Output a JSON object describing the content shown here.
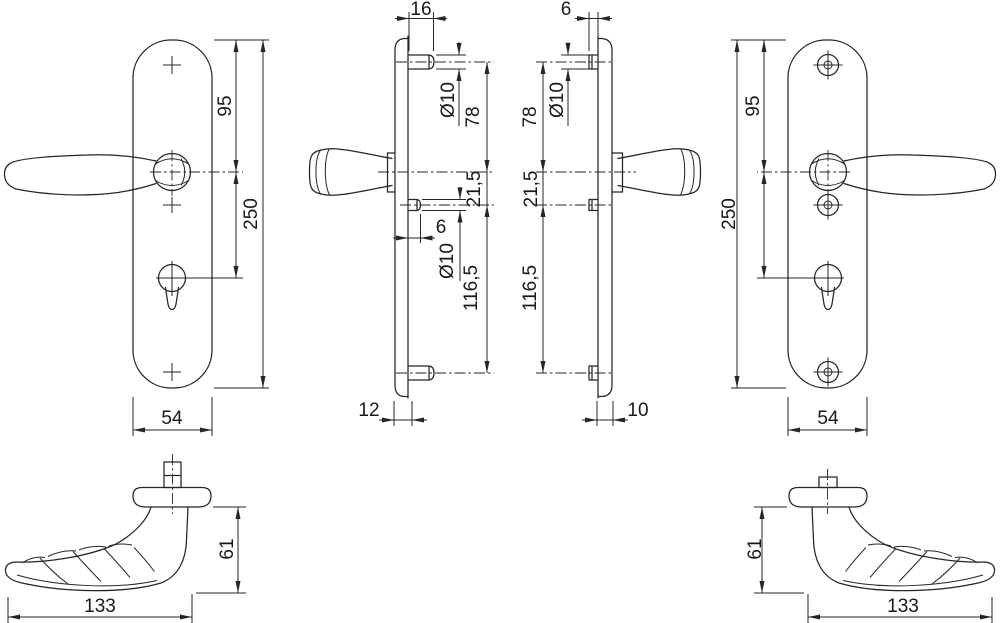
{
  "drawing": {
    "background": "#ffffff",
    "line_color": "#262626",
    "figures": {
      "front_left": {
        "top_to_handle": "95",
        "total_height": "250",
        "plate_width": "54"
      },
      "side_left": {
        "top_stud_length": "16",
        "top_stud_diameter": "Ø10",
        "top_stud_to_handle": "78",
        "handle_to_mid_stud": "21,5",
        "mid_stud_length": "6",
        "mid_stud_diameter": "Ø10",
        "mid_to_bottom_stud": "116,5",
        "plate_depth": "12"
      },
      "side_right": {
        "top_stud_length": "6",
        "top_stud_diameter": "Ø10",
        "top_stud_to_handle": "78",
        "handle_to_mid_stud": "21,5",
        "mid_to_bottom_stud": "116,5",
        "plate_depth": "10"
      },
      "front_right": {
        "top_to_handle": "95",
        "total_height": "250",
        "plate_width": "54"
      },
      "top_view_left": {
        "handle_height": "61",
        "handle_length": "133"
      },
      "top_view_right": {
        "handle_height": "61",
        "handle_length": "133"
      }
    }
  }
}
